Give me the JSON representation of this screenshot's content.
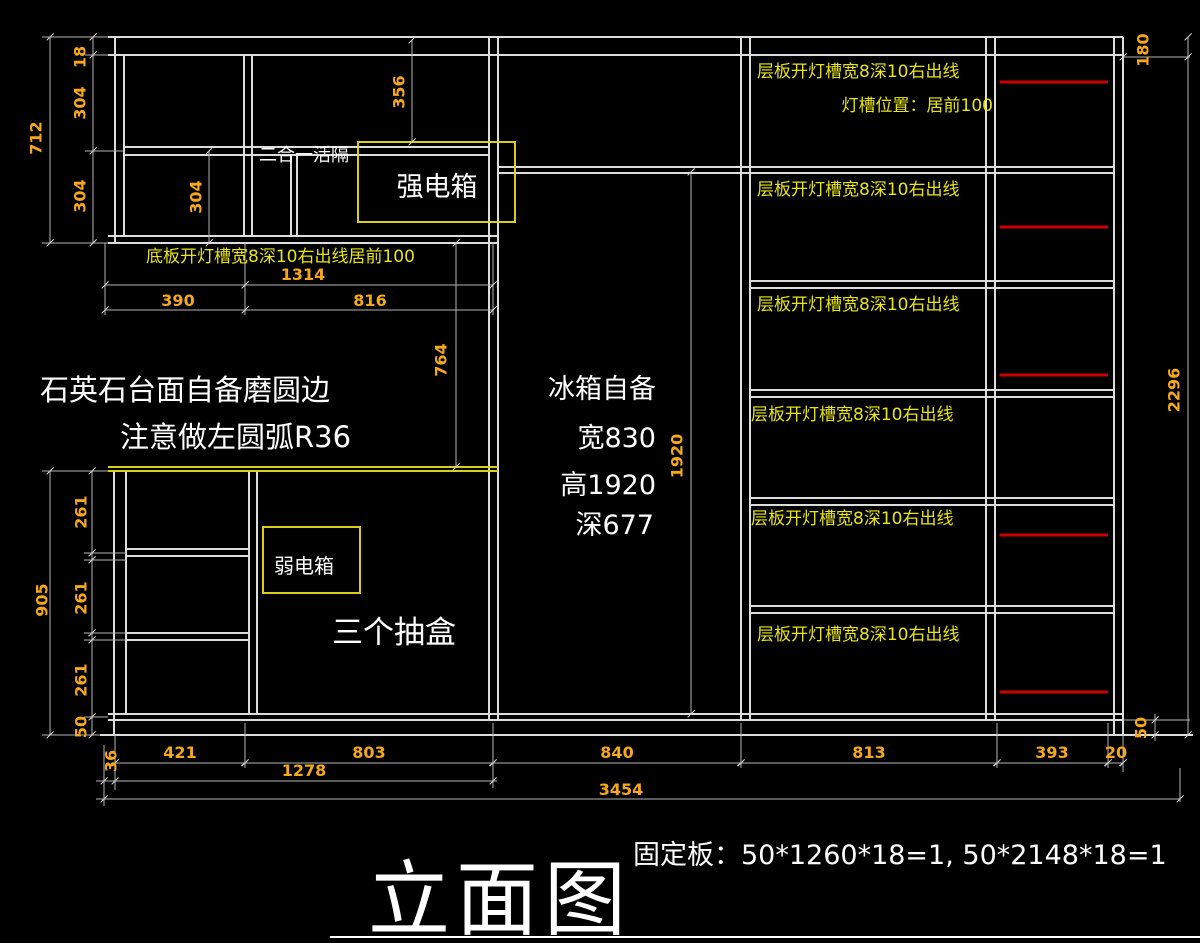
{
  "drawing": {
    "title": "立面图",
    "fixed_board_note": "固定板：50*1260*18=1, 50*2148*18=1"
  },
  "annotations": {
    "combo_divider": "二合一活隔",
    "strong_electric_box": "强电箱",
    "weak_electric_box": "弱电箱",
    "bottom_light_slot": "底板开灯槽宽8深10右出线居前100",
    "countertop_line1": "石英石台面自备磨圆边",
    "countertop_line2": "注意做左圆弧R36",
    "fridge": {
      "line1": "冰箱自备",
      "line2": "宽830",
      "line3": "高1920",
      "line4": "深677"
    },
    "drawers": "三个抽盒",
    "shelf_light_slot": "层板开灯槽宽8深10右出线",
    "light_slot_position": "灯槽位置：居前100"
  },
  "dims": {
    "18": "18",
    "20": "20",
    "36": "36",
    "50": "50",
    "180": "180",
    "261": "261",
    "304": "304",
    "356": "356",
    "390": "390",
    "393": "393",
    "421": "421",
    "712": "712",
    "764": "764",
    "803": "803",
    "813": "813",
    "816": "816",
    "840": "840",
    "905": "905",
    "1278": "1278",
    "1314": "1314",
    "1920": "1920",
    "2296": "2296",
    "3454": "3454"
  },
  "colors": {
    "background": "#000000",
    "structure_line": "#dcdcdc",
    "dimension_text": "#f5a81c",
    "label_text": "#e8e416",
    "highlight_box": "#d8cf1d",
    "light_strip_red": "#cc0000",
    "note_text": "#ffffff"
  }
}
